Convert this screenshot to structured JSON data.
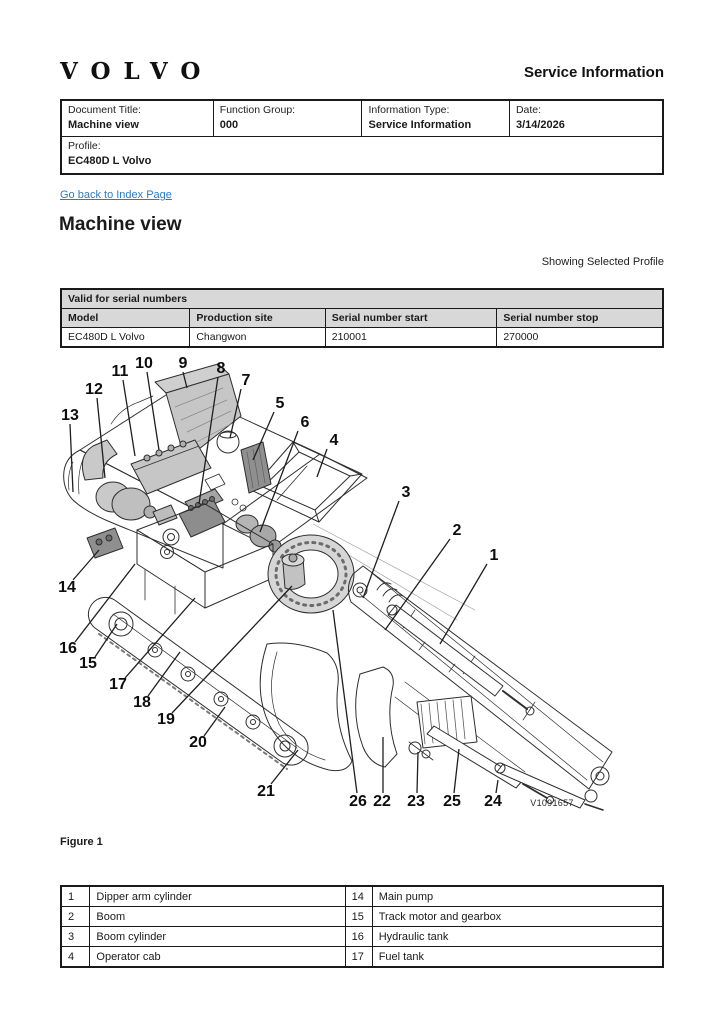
{
  "header": {
    "logo": "VOLVO",
    "title": "Service Information"
  },
  "doc_table": {
    "fields": [
      {
        "label": "Document Title:",
        "value": "Machine view"
      },
      {
        "label": "Function Group:",
        "value": "000"
      },
      {
        "label": "Information Type:",
        "value": "Service Information"
      },
      {
        "label": "Date:",
        "value": "3/14/2026"
      }
    ],
    "profile": {
      "label": "Profile:",
      "value": "EC480D L Volvo"
    }
  },
  "link": {
    "text": "Go back to Index Page"
  },
  "page_title": "Machine view",
  "profile_note": "Showing Selected Profile",
  "serial_table": {
    "title": "Valid for serial numbers",
    "headers": [
      "Model",
      "Production site",
      "Serial number start",
      "Serial number stop"
    ],
    "rows": [
      [
        "EC480D L Volvo",
        "Changwon",
        "210001",
        "270000"
      ]
    ]
  },
  "figure": {
    "caption": "Figure 1",
    "watermark": "V1091657",
    "callouts": [
      {
        "n": "1",
        "x": 439,
        "y": 204
      },
      {
        "n": "2",
        "x": 402,
        "y": 179
      },
      {
        "n": "3",
        "x": 351,
        "y": 141
      },
      {
        "n": "4",
        "x": 279,
        "y": 89
      },
      {
        "n": "5",
        "x": 225,
        "y": 52
      },
      {
        "n": "6",
        "x": 250,
        "y": 71
      },
      {
        "n": "7",
        "x": 191,
        "y": 29
      },
      {
        "n": "8",
        "x": 166,
        "y": 17
      },
      {
        "n": "9",
        "x": 128,
        "y": 12
      },
      {
        "n": "10",
        "x": 89,
        "y": 12
      },
      {
        "n": "11",
        "x": 65,
        "y": 20
      },
      {
        "n": "12",
        "x": 39,
        "y": 38
      },
      {
        "n": "13",
        "x": 15,
        "y": 64
      },
      {
        "n": "14",
        "x": 12,
        "y": 236
      },
      {
        "n": "15",
        "x": 33,
        "y": 312
      },
      {
        "n": "16",
        "x": 13,
        "y": 297
      },
      {
        "n": "17",
        "x": 63,
        "y": 333
      },
      {
        "n": "18",
        "x": 87,
        "y": 351
      },
      {
        "n": "19",
        "x": 111,
        "y": 368
      },
      {
        "n": "20",
        "x": 143,
        "y": 391
      },
      {
        "n": "21",
        "x": 211,
        "y": 440
      },
      {
        "n": "22",
        "x": 327,
        "y": 450
      },
      {
        "n": "23",
        "x": 361,
        "y": 450
      },
      {
        "n": "24",
        "x": 438,
        "y": 450
      },
      {
        "n": "25",
        "x": 397,
        "y": 450
      },
      {
        "n": "26",
        "x": 303,
        "y": 450
      }
    ]
  },
  "parts_table": {
    "rows": [
      [
        "1",
        "Dipper arm cylinder",
        "14",
        "Main pump"
      ],
      [
        "2",
        "Boom",
        "15",
        "Track motor and gearbox"
      ],
      [
        "3",
        "Boom cylinder",
        "16",
        "Hydraulic tank"
      ],
      [
        "4",
        "Operator cab",
        "17",
        "Fuel tank"
      ]
    ]
  }
}
